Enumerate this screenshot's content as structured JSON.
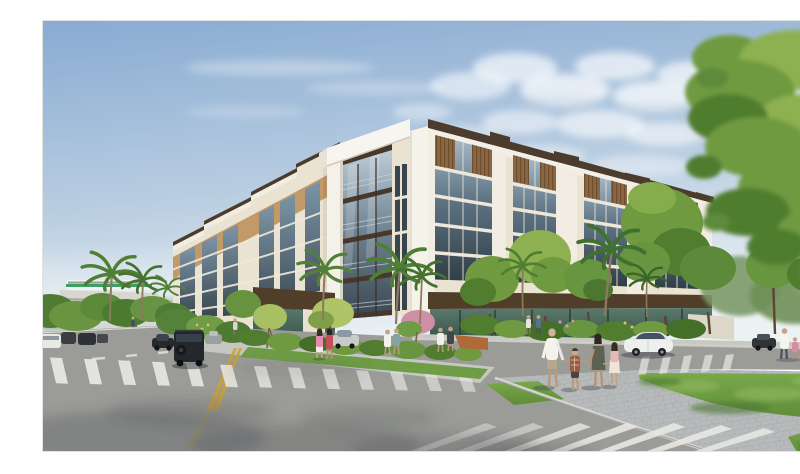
{
  "scene": {
    "description": "Architectural rendering of a six-story cream and bronze mixed-use residential building on a sunny street corner, with a glass-balcony corner tower, ground-floor glass storefronts, tropical landscaping with palms and flowering shrubs, pedestrians including a family of four walking on a paver path, cars on the streets, crosswalks, a green lawn, an elevated train guideway in the distance, and a large overhanging tree at the right under a blue sky with scattered clouds.",
    "elements": [
      "six-story mixed-use building",
      "corner glass balcony tower",
      "bronze slat accent panels",
      "ground-floor glass storefront",
      "elevated rail guideway with green-striped train",
      "palm trees and flowering shrubs",
      "family of four pedestrians",
      "storefront pedestrians",
      "street with cars and parked SUV",
      "white sedan on cross street",
      "striped crosswalks",
      "paver plaza and green lawn",
      "overhanging poinciana tree"
    ]
  },
  "palette": {
    "sky_top": "#88abd2",
    "sky_mid": "#b9cde1",
    "sky_horizon": "#eaf0f4",
    "cloud": "#fbfcfd",
    "building_cream": "#ebe3d1",
    "building_white": "#f5f2ea",
    "building_tan": "#c19a67",
    "panel_brown": "#8a6742",
    "panel_brown_dark": "#6d4f2f",
    "cornice_brown": "#4c3c2d",
    "glass_light": "#a8bcca",
    "glass_dark": "#303d47",
    "storefront_fascia": "#503d2a",
    "storefront_glass": "#3d564a",
    "asphalt": "#9b9b97",
    "asphalt_far": "#b3b2ae",
    "paver": "#b7babb",
    "sidewalk": "#c9c9c3",
    "grass": "#72a047",
    "grass_dark": "#567f34",
    "foliage_light": "#8db051",
    "foliage_mid": "#6f9a3f",
    "foliage_dark": "#507d2e",
    "palm_green": "#4e7f33",
    "trunk": "#6b543c",
    "marking_white": "#e9e8e4",
    "marking_yellow": "#c8a23c",
    "train_green": "#3f9e63",
    "concrete": "#d8d6cf",
    "shadow": "#474b52"
  }
}
